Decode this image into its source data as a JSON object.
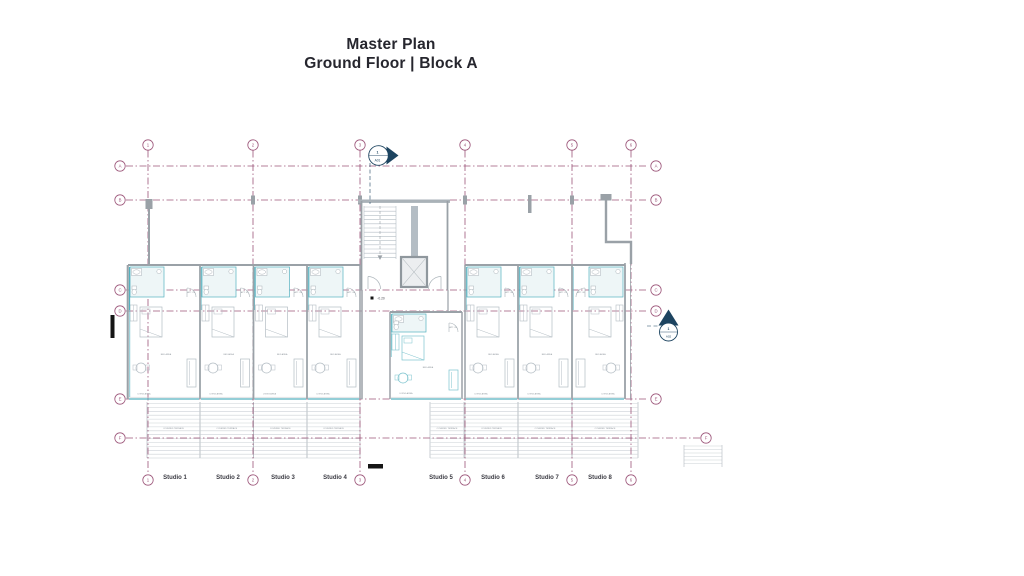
{
  "title": {
    "line1": "Master Plan",
    "line2": "Ground Floor | Block A"
  },
  "plan": {
    "grid_columns": [
      "1",
      "2",
      "3",
      "4",
      "5",
      "6"
    ],
    "grid_rows": [
      "A",
      "B",
      "C",
      "D",
      "E",
      "F"
    ],
    "studios": [
      {
        "label": "Studio 1",
        "apt": "APT. 01"
      },
      {
        "label": "Studio 2",
        "apt": "APT. 02"
      },
      {
        "label": "Studio 3",
        "apt": "APT. 03"
      },
      {
        "label": "Studio 4",
        "apt": "APT. 04"
      },
      {
        "label": "Studio 5",
        "apt": "APT. 05"
      },
      {
        "label": "Studio 6",
        "apt": "APT. 06"
      },
      {
        "label": "Studio 7",
        "apt": "APT. 07"
      },
      {
        "label": "Studio 8",
        "apt": "APT. 08"
      }
    ],
    "room_labels": {
      "bed": "BED AREA",
      "living": "LIVING AREA",
      "terrace": "COVERED TERRACE"
    },
    "level_marker": "-0.20",
    "section_markers": {
      "top": {
        "number": "1",
        "sheet": "A01"
      },
      "right": {
        "number": "1",
        "sheet": "A02"
      }
    }
  },
  "colors": {
    "grid": "#9c5579",
    "teal": "#55b1bf",
    "teal_light": "#eef6f7",
    "wall": "#9aa1a7",
    "furniture": "#b4bdc4",
    "deck": "#ccd1d6",
    "marker_navy": "#1d4460",
    "title_text": "#26262e",
    "black": "#151515",
    "label_gray": "#8d959c",
    "studio_label": "#3a3a42"
  }
}
